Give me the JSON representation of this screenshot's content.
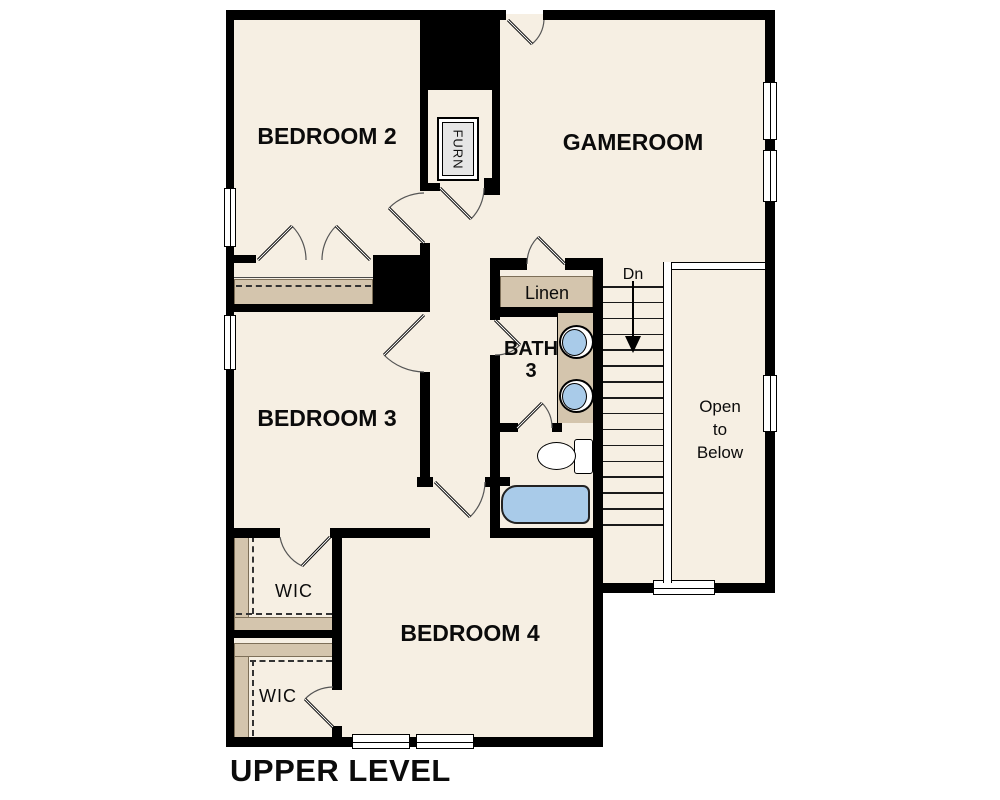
{
  "title": "UPPER LEVEL",
  "labels": {
    "bedroom2": "BEDROOM 2",
    "gameroom": "GAMEROOM",
    "bedroom3": "BEDROOM 3",
    "bedroom4": "BEDROOM 4",
    "bath_line1": "BATH",
    "bath_line2": "3",
    "linen": "Linen",
    "wic_top": "WIC",
    "wic_bottom": "WIC",
    "furnace": "FURN",
    "open_below_line1": "Open",
    "open_below_line2": "to",
    "open_below_line3": "Below"
  },
  "stairs": {
    "direction_label": "Dn",
    "tread_count": 16
  },
  "colors": {
    "floor": "#f6efe3",
    "wall": "#000000",
    "shelf": "#d4c5ad",
    "fixture_blue": "#a9cbe9",
    "background": "#ffffff",
    "appliance_gray": "#e6e6e6"
  }
}
